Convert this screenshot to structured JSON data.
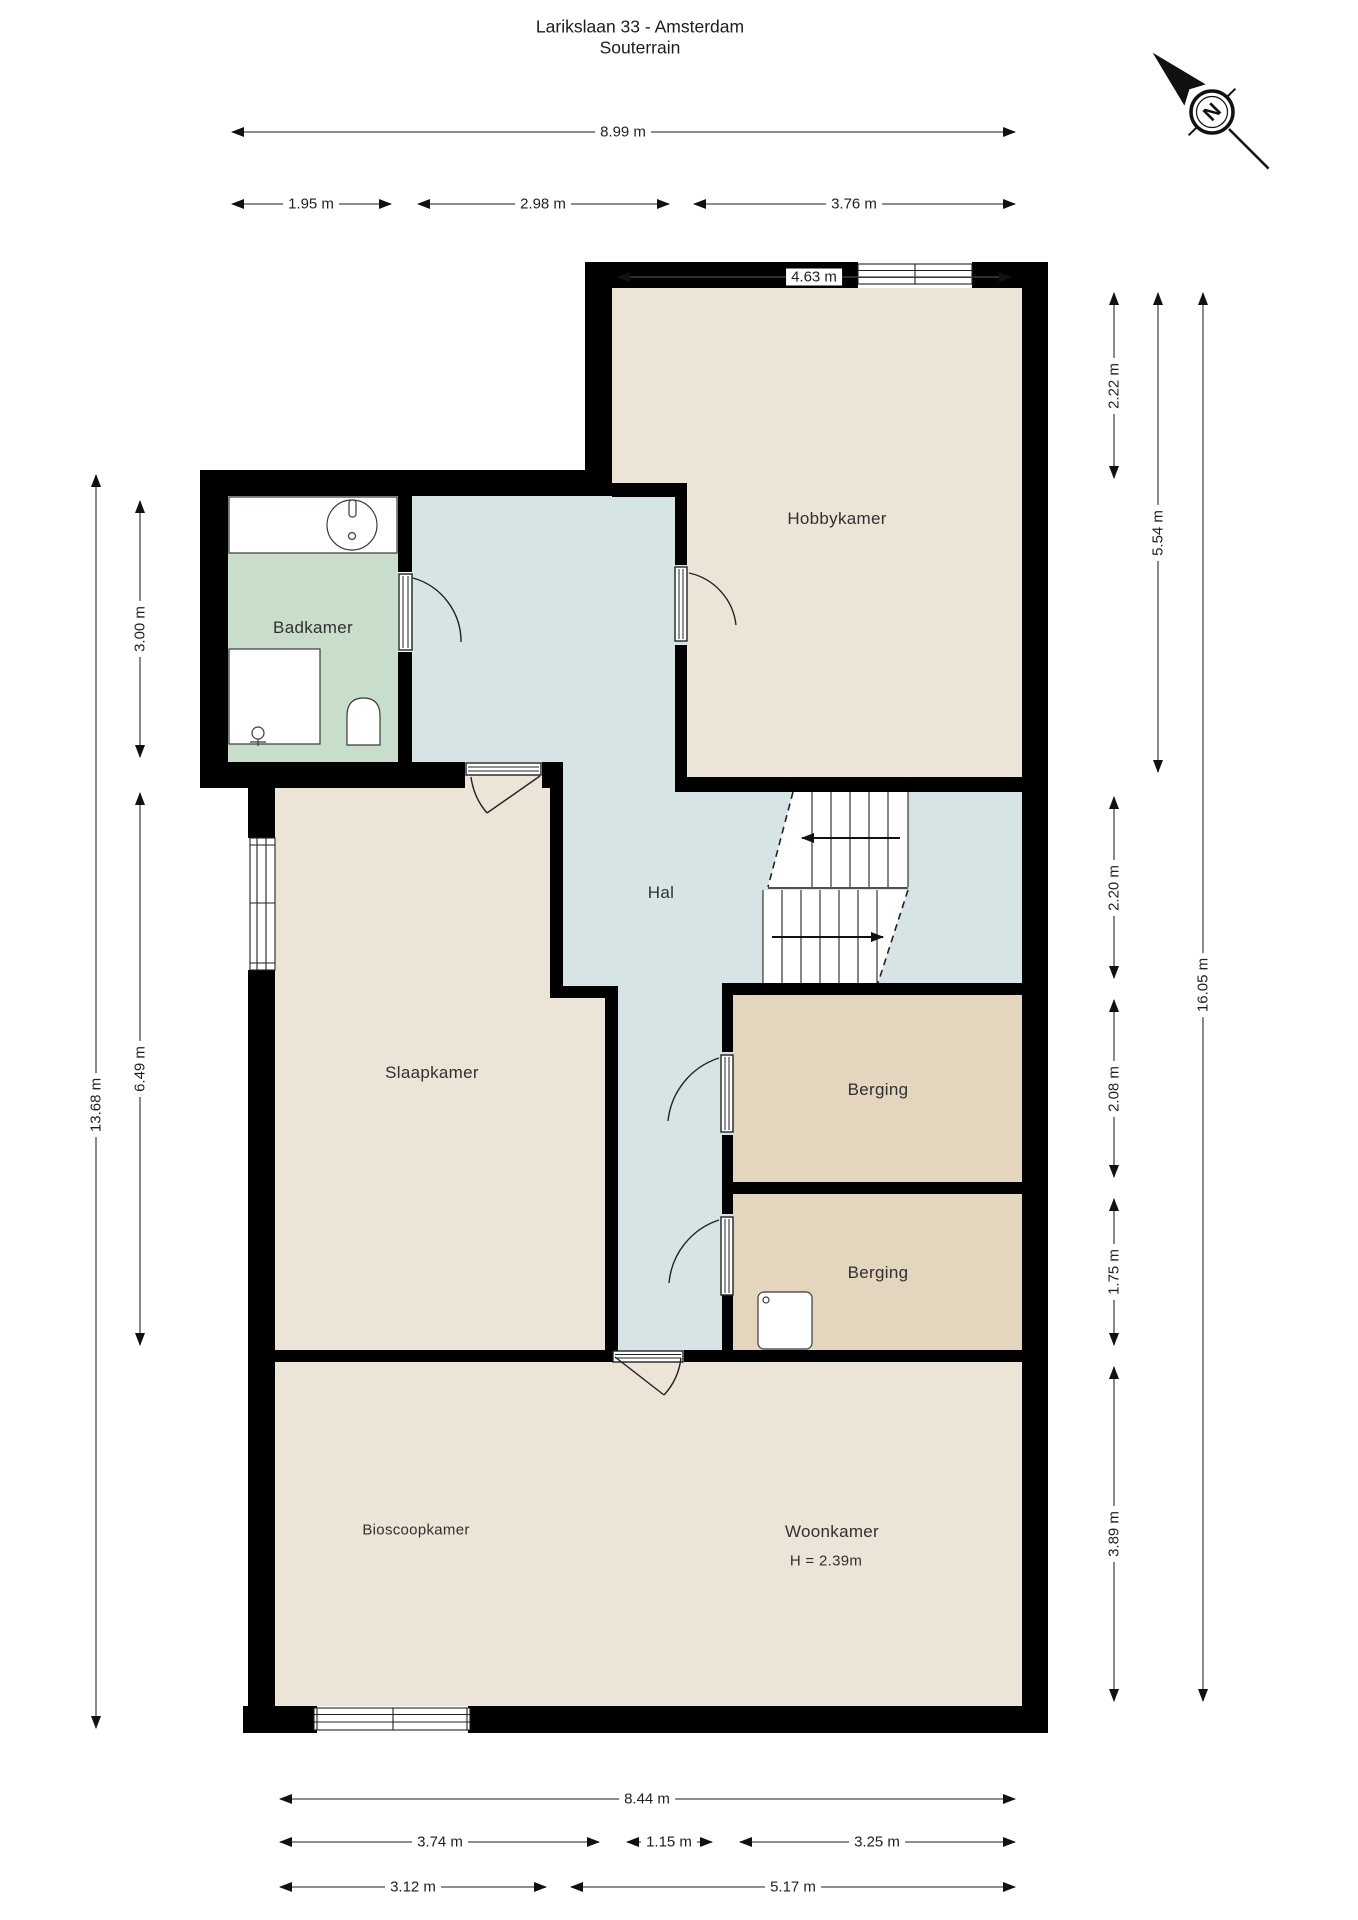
{
  "title": {
    "line1": "Larikslaan 33 - Amsterdam",
    "line2": "Souterrain"
  },
  "compass": {
    "label": "N"
  },
  "rooms": {
    "badkamer": "Badkamer",
    "hobbykamer": "Hobbykamer",
    "hal": "Hal",
    "slaapkamer": "Slaapkamer",
    "berging1": "Berging",
    "berging2": "Berging",
    "bioscoopkamer": "Bioscoopkamer",
    "woonkamer": "Woonkamer",
    "woonkamer_height": "H = 2.39m"
  },
  "dims": {
    "top": [
      "8.99 m",
      "1.95 m",
      "2.98 m",
      "3.76 m",
      "4.63 m"
    ],
    "bottom": [
      "8.44 m",
      "3.74 m",
      "1.15 m",
      "3.25 m",
      "3.12 m",
      "5.17 m"
    ],
    "left": [
      "13.68 m",
      "3.00 m",
      "6.49 m"
    ],
    "right": [
      "2.22 m",
      "5.54 m",
      "2.20 m",
      "2.08 m",
      "1.75 m",
      "3.89 m",
      "16.05 m"
    ]
  },
  "colors": {
    "wall": "#000000",
    "room_beige": "#EDE4D8",
    "room_green": "#C8DDCA",
    "room_blue": "#D7E4E5",
    "room_tan": "#E3D5BE",
    "dimension_line": "#4A4A4A",
    "text": "#303030"
  }
}
